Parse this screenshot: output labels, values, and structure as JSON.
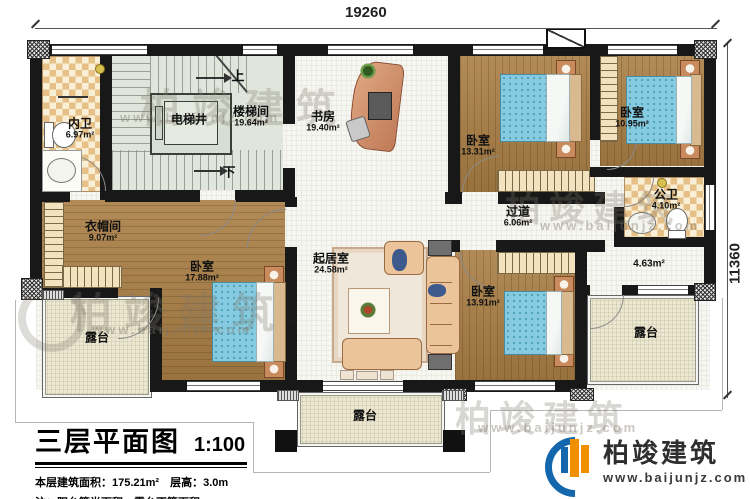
{
  "plan": {
    "dim_top": "19260",
    "dim_right": "11360",
    "stair_up": "上",
    "stair_down": "下"
  },
  "rooms": {
    "neiwei": {
      "name": "内卫",
      "area": "6.97m²"
    },
    "diantijing": {
      "name": "电梯井",
      "area": ""
    },
    "loutijian": {
      "name": "楼梯间",
      "area": "19.64m²"
    },
    "shufang": {
      "name": "书房",
      "area": "19.40m²"
    },
    "woshi_a": {
      "name": "卧室",
      "area": "13.31m²"
    },
    "woshi_b": {
      "name": "卧室",
      "area": "10.95m²"
    },
    "gongwei": {
      "name": "公卫",
      "area": "4.10m²"
    },
    "guodao": {
      "name": "过道",
      "area": "6.06m²"
    },
    "yimaojian": {
      "name": "衣帽间",
      "area": "9.07m²"
    },
    "woshi_c": {
      "name": "卧室",
      "area": "17.88m²"
    },
    "qijushi": {
      "name": "起居室",
      "area": "24.58m²"
    },
    "woshi_d": {
      "name": "卧室",
      "area": "13.91m²"
    },
    "balcony": {
      "name": "",
      "area": "4.63m²"
    },
    "lutai_left": {
      "name": "露台",
      "area": ""
    },
    "lutai_bottom": {
      "name": "露台",
      "area": ""
    },
    "lutai_right": {
      "name": "露台",
      "area": ""
    }
  },
  "title_block": {
    "title": "三层平面图",
    "scale": "1:100",
    "info_line": "本层建筑面积：175.21m²　层高：3.0m",
    "note_line": "注：阳台算半面积，露台不算面积"
  },
  "brand": {
    "name": "柏竣建筑",
    "website": "www.baijunjz.com"
  },
  "watermark": {
    "text": "柏竣建筑",
    "url": "www.baijunjz.com"
  }
}
